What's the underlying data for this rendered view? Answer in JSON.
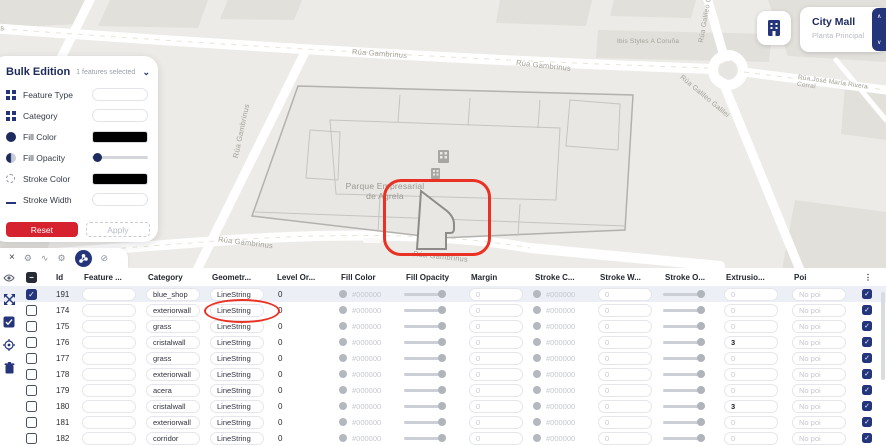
{
  "map": {
    "labels": [
      {
        "text": "Gambrinus"
      },
      {
        "text": "Rúa Gambrinus"
      },
      {
        "text": "Rúa Gambrinus"
      },
      {
        "text": "Ibis Styles A Coruña"
      },
      {
        "text": "Rúa Galileo Galilei"
      },
      {
        "text": "Rúa Galileo Galilei"
      },
      {
        "text": "Rúa José María Rivera Corral"
      },
      {
        "text": "Parque Empresarial\nde Agrela"
      },
      {
        "text": "Rúa Gambrinus"
      },
      {
        "text": "Rúa Gambrinus"
      },
      {
        "text": "Rúa Gambrinus"
      }
    ]
  },
  "poi_card": {
    "title": "City Mall",
    "subtitle": "Planta Principal",
    "icon": "building-icon"
  },
  "bulk_panel": {
    "title": "Bulk Edition",
    "selection": "1 features selected",
    "fields": [
      {
        "label": "Feature Type",
        "icon": "grid-icon",
        "control": "input"
      },
      {
        "label": "Category",
        "icon": "grid-icon",
        "control": "input"
      },
      {
        "label": "Fill Color",
        "icon": "filled-circle-icon",
        "control": "swatch",
        "value": "#000000"
      },
      {
        "label": "Fill Opacity",
        "icon": "half-circle-icon",
        "control": "slider",
        "value": 0.05
      },
      {
        "label": "Stroke Color",
        "icon": "dashed-circle-icon",
        "control": "swatch",
        "value": "#000000"
      },
      {
        "label": "Stroke Width",
        "icon": "line-icon",
        "control": "input"
      },
      {
        "label": "Stroke Opacity",
        "icon": "square-icon",
        "control": "slider",
        "value": 0.28
      }
    ],
    "reset_label": "Reset",
    "apply_label": "Apply"
  },
  "toolbar": {
    "close_glyph": "×",
    "icons": [
      {
        "name": "gear-icon",
        "glyph": "⚙"
      },
      {
        "name": "route-icon",
        "glyph": "∿"
      },
      {
        "name": "settings-icon",
        "glyph": "⚙"
      },
      {
        "name": "graph-share-icon",
        "glyph": "",
        "selected": true
      },
      {
        "name": "disabled-icon",
        "glyph": "⊘"
      }
    ]
  },
  "side_icons": [
    "visibility-eye-icon",
    "fit-arrows-icon",
    "select-all-icon",
    "target-icon",
    "trash-icon"
  ],
  "table": {
    "columns": [
      "Id",
      "Feature ...",
      "Category",
      "Geometr...",
      "Level Or...",
      "Fill Color",
      "Fill Opacity",
      "Margin",
      "Stroke C...",
      "Stroke W...",
      "Stroke O...",
      "Extrusio...",
      "Poi",
      "⋮"
    ],
    "rows": [
      {
        "id": "191",
        "feature": "",
        "category": "blue_shop",
        "geometry": "LineString",
        "level": "0",
        "fill_color": "#000000",
        "margin": "0",
        "stroke_color": "#000000",
        "stroke_width": "0",
        "extrusion": "0",
        "poi": "No poi",
        "selected": true,
        "flag_checked": true
      },
      {
        "id": "174",
        "feature": "",
        "category": "exteriorwall",
        "geometry": "LineString",
        "level": "0",
        "fill_color": "#000000",
        "margin": "0",
        "stroke_color": "#000000",
        "stroke_width": "0",
        "extrusion": "0",
        "poi": "No poi",
        "selected": false,
        "flag_checked": true
      },
      {
        "id": "175",
        "feature": "",
        "category": "grass",
        "geometry": "LineString",
        "level": "0",
        "fill_color": "#000000",
        "margin": "0",
        "stroke_color": "#000000",
        "stroke_width": "0",
        "extrusion": "0",
        "poi": "No poi",
        "selected": false,
        "flag_checked": true
      },
      {
        "id": "176",
        "feature": "",
        "category": "cristalwall",
        "geometry": "LineString",
        "level": "0",
        "fill_color": "#000000",
        "margin": "0",
        "stroke_color": "#000000",
        "stroke_width": "0",
        "extrusion": "3",
        "poi": "No poi",
        "selected": false,
        "flag_checked": true
      },
      {
        "id": "177",
        "feature": "",
        "category": "grass",
        "geometry": "LineString",
        "level": "0",
        "fill_color": "#000000",
        "margin": "0",
        "stroke_color": "#000000",
        "stroke_width": "0",
        "extrusion": "0",
        "poi": "No poi",
        "selected": false,
        "flag_checked": true
      },
      {
        "id": "178",
        "feature": "",
        "category": "exteriorwall",
        "geometry": "LineString",
        "level": "0",
        "fill_color": "#000000",
        "margin": "0",
        "stroke_color": "#000000",
        "stroke_width": "0",
        "extrusion": "0",
        "poi": "No poi",
        "selected": false,
        "flag_checked": true
      },
      {
        "id": "179",
        "feature": "",
        "category": "acera",
        "geometry": "LineString",
        "level": "0",
        "fill_color": "#000000",
        "margin": "0",
        "stroke_color": "#000000",
        "stroke_width": "0",
        "extrusion": "0",
        "poi": "No poi",
        "selected": false,
        "flag_checked": true
      },
      {
        "id": "180",
        "feature": "",
        "category": "cristalwall",
        "geometry": "LineString",
        "level": "0",
        "fill_color": "#000000",
        "margin": "0",
        "stroke_color": "#000000",
        "stroke_width": "0",
        "extrusion": "3",
        "poi": "No poi",
        "selected": false,
        "flag_checked": true
      },
      {
        "id": "181",
        "feature": "",
        "category": "exteriorwall",
        "geometry": "LineString",
        "level": "0",
        "fill_color": "#000000",
        "margin": "0",
        "stroke_color": "#000000",
        "stroke_width": "0",
        "extrusion": "0",
        "poi": "No poi",
        "selected": false,
        "flag_checked": true
      },
      {
        "id": "182",
        "feature": "",
        "category": "corridor",
        "geometry": "LineString",
        "level": "0",
        "fill_color": "#000000",
        "margin": "0",
        "stroke_color": "#000000",
        "stroke_width": "0",
        "extrusion": "0",
        "poi": "No poi",
        "selected": false,
        "flag_checked": true
      }
    ]
  },
  "colors": {
    "navy": "#24357c",
    "annotation_red": "#e93223",
    "reset_red": "#d6212f",
    "map_bg": "#ecebe7",
    "selected_row": "#edeff6"
  }
}
